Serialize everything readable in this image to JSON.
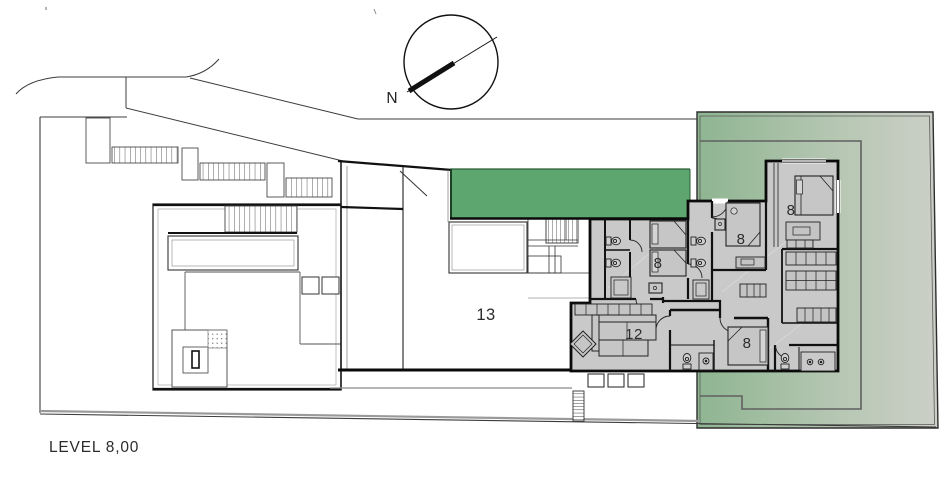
{
  "plan": {
    "level_label": "LEVEL 8,00",
    "compass": {
      "north_label": "N"
    },
    "room_labels": {
      "hall": "13",
      "living_room": "12",
      "bedroom_middle": "8",
      "bedroom_upper_right": "8",
      "bedroom_top_right": "8",
      "bedroom_bottom_right": "8"
    },
    "colors": {
      "planted_roof_green": "#5da66f",
      "garden_green": "#8eb591",
      "garden_green_fade": "#cccfc7",
      "room_fill_gray": "#c9c9c9",
      "wall_black": "#0a0a0a",
      "line_gray": "#3c3c3c"
    }
  }
}
